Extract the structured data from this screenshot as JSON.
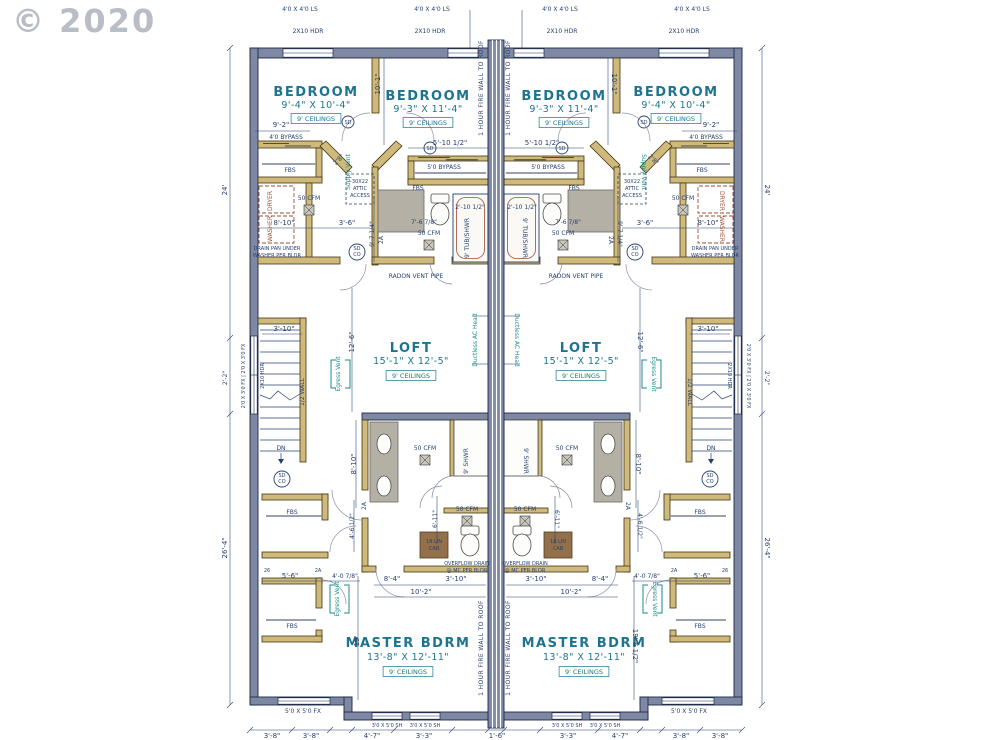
{
  "watermark": "© 2020",
  "summary": {
    "drawing_type": "duplex upper floor plan, mirrored units",
    "units": 2,
    "separation": "1 HOUR FIRE WALL TO ROOF",
    "rooms_per_unit": [
      {
        "name": "BEDROOM",
        "size": "9'-4\" X 10'-4\"",
        "ceiling": "9' CEILINGS"
      },
      {
        "name": "BEDROOM",
        "size": "9'-3\" X 11'-4\"",
        "ceiling": "9' CEILINGS"
      },
      {
        "name": "LOFT",
        "size": "15'-1\" X 12'-5\"",
        "ceiling": "9' CEILINGS"
      },
      {
        "name": "MASTER BDRM",
        "size": "13'-8\" X 12'-11\"",
        "ceiling": "9' CEILINGS"
      }
    ],
    "colors": {
      "wall_outline": "#1e2a4a",
      "wall_fill": "#7e88a2",
      "interior_wall": "#cfb97b",
      "room_text": "#1d7490",
      "dim_text": "#26406f",
      "accent_red": "#9b4f35",
      "vent_teal": "#1c8a8a",
      "watermark": "#a7adb8"
    }
  },
  "labels": [
    {
      "t": "4'0 X 4'0 LS",
      "x": 300,
      "y": 11
    },
    {
      "t": "4'0 X 4'0 LS",
      "x": 432,
      "y": 11
    },
    {
      "t": "4'0 X 4'0 LS",
      "x": 560,
      "y": 11
    },
    {
      "t": "4'0 X 4'0 LS",
      "x": 692,
      "y": 11
    },
    {
      "t": "2X10 HDR",
      "x": 308,
      "y": 33
    },
    {
      "t": "2X10 HDR",
      "x": 430,
      "y": 33
    },
    {
      "t": "2X10 HDR",
      "x": 562,
      "y": 33
    },
    {
      "t": "2X10 HDR",
      "x": 684,
      "y": 33
    },
    {
      "t": "BEDROOM",
      "x": 316,
      "y": 96,
      "c": "rm"
    },
    {
      "t": "9'-4\" X 10'-4\"",
      "x": 316,
      "y": 108,
      "c": "rd"
    },
    {
      "t": "9' CEILINGS",
      "x": 316,
      "y": 121,
      "c": "cb"
    },
    {
      "t": "BEDROOM",
      "x": 428,
      "y": 100,
      "c": "rm"
    },
    {
      "t": "9'-3\" X 11'-4\"",
      "x": 428,
      "y": 112,
      "c": "rd"
    },
    {
      "t": "9' CEILINGS",
      "x": 428,
      "y": 125,
      "c": "cb"
    },
    {
      "t": "BEDROOM",
      "x": 564,
      "y": 100,
      "c": "rm"
    },
    {
      "t": "9'-3\" X 11'-4\"",
      "x": 564,
      "y": 112,
      "c": "rd"
    },
    {
      "t": "9' CEILINGS",
      "x": 564,
      "y": 125,
      "c": "cb"
    },
    {
      "t": "BEDROOM",
      "x": 676,
      "y": 96,
      "c": "rm"
    },
    {
      "t": "9'-4\" X 10'-4\"",
      "x": 676,
      "y": 108,
      "c": "rd"
    },
    {
      "t": "9' CEILINGS",
      "x": 676,
      "y": 121,
      "c": "cb"
    },
    {
      "t": "LOFT",
      "x": 411,
      "y": 352,
      "c": "rm"
    },
    {
      "t": "15'-1\" X 12'-5\"",
      "x": 411,
      "y": 364,
      "c": "rd"
    },
    {
      "t": "9' CEILINGS",
      "x": 411,
      "y": 378,
      "c": "cb"
    },
    {
      "t": "LOFT",
      "x": 581,
      "y": 352,
      "c": "rm"
    },
    {
      "t": "15'-1\" X 12'-5\"",
      "x": 581,
      "y": 364,
      "c": "rd"
    },
    {
      "t": "9' CEILINGS",
      "x": 581,
      "y": 378,
      "c": "cb"
    },
    {
      "t": "MASTER BDRM",
      "x": 408,
      "y": 647,
      "c": "rm"
    },
    {
      "t": "13'-8\" X 12'-11\"",
      "x": 408,
      "y": 660,
      "c": "rd"
    },
    {
      "t": "9' CEILINGS",
      "x": 408,
      "y": 674,
      "c": "cb"
    },
    {
      "t": "MASTER BDRM",
      "x": 584,
      "y": 647,
      "c": "rm"
    },
    {
      "t": "13'-8\" X 12'-11\"",
      "x": 584,
      "y": 660,
      "c": "rd"
    },
    {
      "t": "9' CEILINGS",
      "x": 584,
      "y": 674,
      "c": "cb"
    },
    {
      "t": "1 HOUR FIRE WALL TO ROOF",
      "x": 483,
      "y": 88,
      "r": -90,
      "c": "fw"
    },
    {
      "t": "1 HOUR FIRE WALL TO ROOF",
      "x": 510,
      "y": 88,
      "r": -90,
      "c": "fw"
    },
    {
      "t": "1 HOUR FIRE WALL TO ROOF",
      "x": 483,
      "y": 648,
      "r": -90,
      "c": "fw"
    },
    {
      "t": "1 HOUR FIRE WALL TO ROOF",
      "x": 510,
      "y": 648,
      "r": -90,
      "c": "fw"
    },
    {
      "t": "9'-2\"",
      "x": 281,
      "y": 127,
      "c": "d"
    },
    {
      "t": "9'-2\"",
      "x": 711,
      "y": 127,
      "c": "d"
    },
    {
      "t": "4'0 BYPASS",
      "x": 286,
      "y": 139
    },
    {
      "t": "4'0 BYPASS",
      "x": 706,
      "y": 139
    },
    {
      "t": "FBS",
      "x": 290,
      "y": 172
    },
    {
      "t": "FBS",
      "x": 702,
      "y": 172
    },
    {
      "t": "50 CFM",
      "x": 309,
      "y": 200
    },
    {
      "t": "50 CFM",
      "x": 683,
      "y": 200
    },
    {
      "t": "DRYER",
      "x": 272,
      "y": 201,
      "r": -90,
      "c": "w"
    },
    {
      "t": "DRYER",
      "x": 720,
      "y": 201,
      "r": 90,
      "c": "w"
    },
    {
      "t": "WASHER",
      "x": 272,
      "y": 229,
      "r": -90,
      "c": "w"
    },
    {
      "t": "WASHER",
      "x": 720,
      "y": 229,
      "r": 90,
      "c": "w"
    },
    {
      "t": "DRAIN PAN UNDER",
      "x": 277,
      "y": 250,
      "c": "t5"
    },
    {
      "t": "WASHER PER BLDR",
      "x": 277,
      "y": 257,
      "c": "t5"
    },
    {
      "t": "DRAIN PAN UNDER",
      "x": 715,
      "y": 250,
      "c": "t5"
    },
    {
      "t": "WASHER PER BLDR",
      "x": 715,
      "y": 257,
      "c": "t5"
    },
    {
      "t": "10'-1\"",
      "x": 380,
      "y": 84,
      "r": -90,
      "c": "d"
    },
    {
      "t": "10'-1\"",
      "x": 612,
      "y": 84,
      "r": 90,
      "c": "d"
    },
    {
      "t": "5'-10 1/2\"",
      "x": 450,
      "y": 145,
      "c": "d"
    },
    {
      "t": "5'-10 1/2\"",
      "x": 542,
      "y": 145,
      "c": "d"
    },
    {
      "t": "5'0 BYPASS",
      "x": 444,
      "y": 169
    },
    {
      "t": "5'0 BYPASS",
      "x": 548,
      "y": 169
    },
    {
      "t": "FBS",
      "x": 418,
      "y": 190
    },
    {
      "t": "FBS",
      "x": 574,
      "y": 190
    },
    {
      "t": "30X22",
      "x": 360,
      "y": 183,
      "c": "t5"
    },
    {
      "t": "ATTIC",
      "x": 360,
      "y": 190,
      "c": "t5"
    },
    {
      "t": "ACCESS",
      "x": 360,
      "y": 197,
      "c": "t5"
    },
    {
      "t": "30X22",
      "x": 632,
      "y": 183,
      "c": "t5"
    },
    {
      "t": "ATTIC",
      "x": 632,
      "y": 190,
      "c": "t5"
    },
    {
      "t": "ACCESS",
      "x": 632,
      "y": 197,
      "c": "t5"
    },
    {
      "t": "Supply Vent",
      "x": 350,
      "y": 172,
      "r": -90,
      "c": "v"
    },
    {
      "t": "Supply Vent",
      "x": 642,
      "y": 172,
      "r": 90,
      "c": "v"
    },
    {
      "t": "2'8\"",
      "x": 340,
      "y": 161,
      "r": -45
    },
    {
      "t": "2'8\"",
      "x": 652,
      "y": 161,
      "r": 45
    },
    {
      "t": "8'-10\"",
      "x": 284,
      "y": 225,
      "c": "d"
    },
    {
      "t": "8'-10\"",
      "x": 708,
      "y": 225,
      "c": "d"
    },
    {
      "t": "3'-6\"",
      "x": 347,
      "y": 225,
      "c": "d"
    },
    {
      "t": "3'-6\"",
      "x": 645,
      "y": 225,
      "c": "d"
    },
    {
      "t": "9'-7 1/4\"",
      "x": 374,
      "y": 234,
      "r": -90
    },
    {
      "t": "9'-7 1/4\"",
      "x": 618,
      "y": 234,
      "r": 90
    },
    {
      "t": "2A",
      "x": 383,
      "y": 240,
      "r": -90
    },
    {
      "t": "2A",
      "x": 609,
      "y": 240,
      "r": 90
    },
    {
      "t": "2'-10 1/2\"",
      "x": 470,
      "y": 209
    },
    {
      "t": "2'-10 1/2\"",
      "x": 522,
      "y": 209
    },
    {
      "t": "7'-6 7/8\"",
      "x": 424,
      "y": 224
    },
    {
      "t": "7'-6 7/8\"",
      "x": 568,
      "y": 224
    },
    {
      "t": "9' TUB/SHWR",
      "x": 469,
      "y": 238,
      "r": -90
    },
    {
      "t": "9' TUB/SHWR",
      "x": 523,
      "y": 238,
      "r": 90
    },
    {
      "t": "50 CFM",
      "x": 429,
      "y": 235
    },
    {
      "t": "50 CFM",
      "x": 563,
      "y": 235
    },
    {
      "t": "SD",
      "x": 357,
      "y": 250,
      "c": "t5"
    },
    {
      "t": "CO",
      "x": 357,
      "y": 256,
      "c": "t5"
    },
    {
      "t": "SD",
      "x": 635,
      "y": 250,
      "c": "t5"
    },
    {
      "t": "CO",
      "x": 635,
      "y": 256,
      "c": "t5"
    },
    {
      "t": "RADON VENT PIPE",
      "x": 416,
      "y": 278
    },
    {
      "t": "RADON VENT PIPE",
      "x": 576,
      "y": 278
    },
    {
      "t": "SD",
      "x": 348,
      "y": 124,
      "c": "t5"
    },
    {
      "t": "SD",
      "x": 430,
      "y": 150,
      "c": "t5"
    },
    {
      "t": "SD",
      "x": 562,
      "y": 150,
      "c": "t5"
    },
    {
      "t": "SD",
      "x": 644,
      "y": 124,
      "c": "t5"
    },
    {
      "t": "24'",
      "x": 227,
      "y": 190,
      "r": -90,
      "c": "d"
    },
    {
      "t": "24'",
      "x": 765,
      "y": 190,
      "r": 90,
      "c": "d"
    },
    {
      "t": "2'-2\"",
      "x": 227,
      "y": 378,
      "r": -90
    },
    {
      "t": "2'-2\"",
      "x": 765,
      "y": 378,
      "r": 90
    },
    {
      "t": "26'-4\"",
      "x": 227,
      "y": 548,
      "r": -90,
      "c": "d"
    },
    {
      "t": "26'-4\"",
      "x": 765,
      "y": 548,
      "r": 90,
      "c": "d"
    },
    {
      "t": "2'0 X 3'0 FX | 2'0 X 3'0 FX",
      "x": 245,
      "y": 376,
      "r": -90,
      "c": "t5"
    },
    {
      "t": "2'0 X 3'0 FX | 2'0 X 3'0 FX",
      "x": 747,
      "y": 376,
      "r": 90,
      "c": "t5"
    },
    {
      "t": "2X10 HDR",
      "x": 264,
      "y": 376,
      "r": -90,
      "c": "t5"
    },
    {
      "t": "2X10 HDR",
      "x": 728,
      "y": 376,
      "r": 90,
      "c": "t5"
    },
    {
      "t": "3'-10\"",
      "x": 284,
      "y": 331,
      "c": "d"
    },
    {
      "t": "3'-10\"",
      "x": 708,
      "y": 331,
      "c": "d"
    },
    {
      "t": "1/2 WALL",
      "x": 304,
      "y": 392,
      "r": -90
    },
    {
      "t": "1/2 WALL",
      "x": 688,
      "y": 392,
      "r": 90
    },
    {
      "t": "DN",
      "x": 281,
      "y": 450
    },
    {
      "t": "DN",
      "x": 711,
      "y": 450
    },
    {
      "t": "SD",
      "x": 282,
      "y": 477,
      "c": "t5"
    },
    {
      "t": "CO",
      "x": 282,
      "y": 483,
      "c": "t5"
    },
    {
      "t": "SD",
      "x": 710,
      "y": 477,
      "c": "t5"
    },
    {
      "t": "CO",
      "x": 710,
      "y": 483,
      "c": "t5"
    },
    {
      "t": "12'-6\"",
      "x": 354,
      "y": 342,
      "r": -90,
      "c": "d"
    },
    {
      "t": "12'-6\"",
      "x": 638,
      "y": 342,
      "r": 90,
      "c": "d"
    },
    {
      "t": "Ductless AC Head",
      "x": 477,
      "y": 340,
      "r": -90,
      "c": "v"
    },
    {
      "t": "Ductless AC Head",
      "x": 515,
      "y": 340,
      "r": 90,
      "c": "v"
    },
    {
      "t": "Egress Vent",
      "x": 340,
      "y": 374,
      "r": -90,
      "c": "v"
    },
    {
      "t": "Egress Vent",
      "x": 652,
      "y": 374,
      "r": 90,
      "c": "v"
    },
    {
      "t": "8'-10\"",
      "x": 356,
      "y": 464,
      "r": -90,
      "c": "d"
    },
    {
      "t": "8'-10\"",
      "x": 636,
      "y": 464,
      "r": 90,
      "c": "d"
    },
    {
      "t": "50 CFM",
      "x": 425,
      "y": 450
    },
    {
      "t": "50 CFM",
      "x": 567,
      "y": 450
    },
    {
      "t": "9' SHWR",
      "x": 468,
      "y": 461,
      "r": -90
    },
    {
      "t": "9' SHWR",
      "x": 524,
      "y": 461,
      "r": 90
    },
    {
      "t": "6'-11\"",
      "x": 437,
      "y": 519,
      "r": -90
    },
    {
      "t": "6'-11\"",
      "x": 555,
      "y": 519,
      "r": 90
    },
    {
      "t": "4'-6 1/2\"",
      "x": 354,
      "y": 526,
      "r": -90
    },
    {
      "t": "4'-6 1/2\"",
      "x": 638,
      "y": 526,
      "r": 90
    },
    {
      "t": "50 CFM",
      "x": 467,
      "y": 511
    },
    {
      "t": "50 CFM",
      "x": 525,
      "y": 511
    },
    {
      "t": "18 LIN",
      "x": 434,
      "y": 543,
      "c": "t5"
    },
    {
      "t": "CAB",
      "x": 434,
      "y": 550,
      "c": "t5"
    },
    {
      "t": "18 LIN",
      "x": 558,
      "y": 543,
      "c": "t5"
    },
    {
      "t": "CAB",
      "x": 558,
      "y": 550,
      "c": "t5"
    },
    {
      "t": "OVERFLOW DRAIN",
      "x": 467,
      "y": 565,
      "c": "t5"
    },
    {
      "t": "@ MC PER BLDR",
      "x": 467,
      "y": 572,
      "c": "t5"
    },
    {
      "t": "OVERFLOW DRAIN",
      "x": 525,
      "y": 565,
      "c": "t5"
    },
    {
      "t": "@ MC PER BLDR",
      "x": 525,
      "y": 572,
      "c": "t5"
    },
    {
      "t": "2A",
      "x": 366,
      "y": 506,
      "r": -90
    },
    {
      "t": "2A",
      "x": 626,
      "y": 506,
      "r": 90
    },
    {
      "t": "FBS",
      "x": 292,
      "y": 514
    },
    {
      "t": "FBS",
      "x": 700,
      "y": 514
    },
    {
      "t": "FBS",
      "x": 292,
      "y": 628
    },
    {
      "t": "FBS",
      "x": 700,
      "y": 628
    },
    {
      "t": "5'-6\"",
      "x": 290,
      "y": 578,
      "c": "d"
    },
    {
      "t": "5'-6\"",
      "x": 702,
      "y": 578,
      "c": "d"
    },
    {
      "t": "4'-0 7/8\"",
      "x": 345,
      "y": 578
    },
    {
      "t": "4'-0 7/8\"",
      "x": 647,
      "y": 578
    },
    {
      "t": "Egress Vent",
      "x": 339,
      "y": 599,
      "r": -90,
      "c": "v"
    },
    {
      "t": "Egress Vent",
      "x": 653,
      "y": 599,
      "r": 90,
      "c": "v"
    },
    {
      "t": "2A",
      "x": 318,
      "y": 572,
      "c": "t5"
    },
    {
      "t": "2A",
      "x": 674,
      "y": 572,
      "c": "t5"
    },
    {
      "t": "26",
      "x": 267,
      "y": 572,
      "c": "t5"
    },
    {
      "t": "26",
      "x": 725,
      "y": 572,
      "c": "t5"
    },
    {
      "t": "8'-4\"",
      "x": 392,
      "y": 581,
      "c": "d"
    },
    {
      "t": "8'-4\"",
      "x": 600,
      "y": 581,
      "c": "d"
    },
    {
      "t": "3'-10\"",
      "x": 456,
      "y": 581,
      "c": "d"
    },
    {
      "t": "3'-10\"",
      "x": 536,
      "y": 581,
      "c": "d"
    },
    {
      "t": "10'-2\"",
      "x": 421,
      "y": 594,
      "c": "d"
    },
    {
      "t": "10'-2\"",
      "x": 571,
      "y": 594,
      "c": "d"
    },
    {
      "t": "19'",
      "x": 359,
      "y": 641,
      "r": -90,
      "c": "d"
    },
    {
      "t": "19'-6 1/2\"",
      "x": 633,
      "y": 646,
      "r": 90,
      "c": "d"
    },
    {
      "t": "5'0 X 5'0 FX",
      "x": 303,
      "y": 713
    },
    {
      "t": "5'0 X 5'0 FX",
      "x": 689,
      "y": 713
    },
    {
      "t": "3'0 X 5'0 SH",
      "x": 387,
      "y": 727,
      "c": "t5"
    },
    {
      "t": "3'0 X 5'0 SH",
      "x": 425,
      "y": 727,
      "c": "t5"
    },
    {
      "t": "3'0 X 5'0 SH",
      "x": 567,
      "y": 727,
      "c": "t5"
    },
    {
      "t": "3'0 X 5'0 SH",
      "x": 605,
      "y": 727,
      "c": "t5"
    },
    {
      "t": "3'-8\"",
      "x": 272,
      "y": 738,
      "c": "d"
    },
    {
      "t": "3'-8\"",
      "x": 311,
      "y": 738,
      "c": "d"
    },
    {
      "t": "4'-7\"",
      "x": 372,
      "y": 738,
      "c": "d"
    },
    {
      "t": "3'-3\"",
      "x": 424,
      "y": 738,
      "c": "d"
    },
    {
      "t": "1'-6\"",
      "x": 497,
      "y": 738,
      "c": "d"
    },
    {
      "t": "3'-3\"",
      "x": 568,
      "y": 738,
      "c": "d"
    },
    {
      "t": "4'-7\"",
      "x": 620,
      "y": 738,
      "c": "d"
    },
    {
      "t": "3'-8\"",
      "x": 681,
      "y": 738,
      "c": "d"
    },
    {
      "t": "3'-8\"",
      "x": 720,
      "y": 738,
      "c": "d"
    }
  ]
}
